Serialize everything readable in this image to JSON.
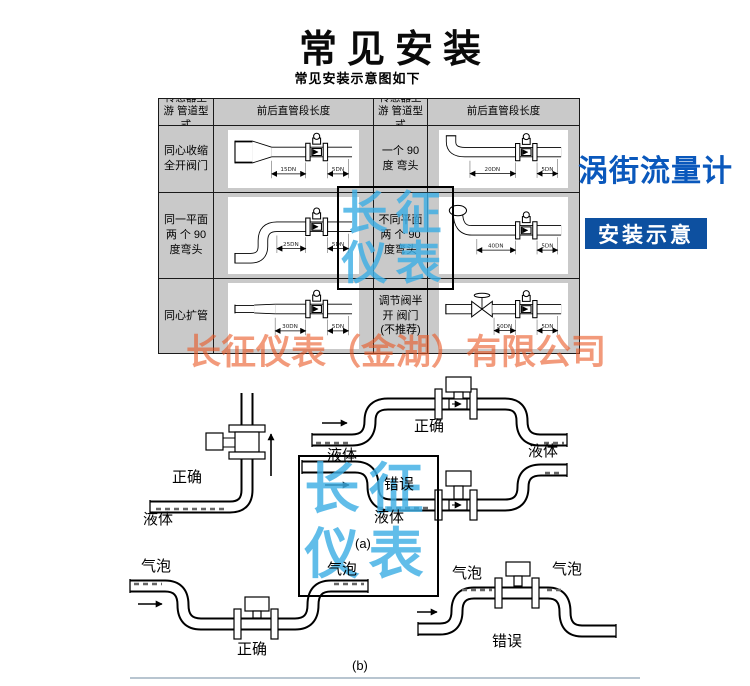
{
  "title": "常见安装",
  "subtitle": "常见安装示意图如下",
  "side": {
    "product": "涡街流量计",
    "badge": "安装示意"
  },
  "watermark": {
    "line1": "长征",
    "line2": "仪表",
    "company": "长征仪表（金湖）有限公司"
  },
  "table": {
    "header_type": "传感器上游 管道型式",
    "header_length": "前后直管段长度",
    "rows": [
      {
        "left_label": "同心收缩 全开阀门",
        "left_up": "15DN",
        "left_down": "5DN",
        "right_label": "一个 90 度 弯头",
        "right_up": "20DN",
        "right_down": "5DN"
      },
      {
        "left_label": "同一平面两 个 90 度弯头",
        "left_up": "25DN",
        "left_down": "5DN",
        "right_label": "不同平面两 个 90 度弯头",
        "right_up": "40DN",
        "right_down": "5DN"
      },
      {
        "left_label": "同心扩管",
        "left_up": "30DN",
        "left_down": "5DN",
        "right_label": "调节阀半开 阀门(不推荐)",
        "right_up": "50DN",
        "right_down": "5DN"
      }
    ]
  },
  "diagram": {
    "correct": "正确",
    "wrong": "错误",
    "liquid": "液体",
    "bubble": "气泡",
    "fig_a": "(a)",
    "fig_b": "(b)"
  }
}
